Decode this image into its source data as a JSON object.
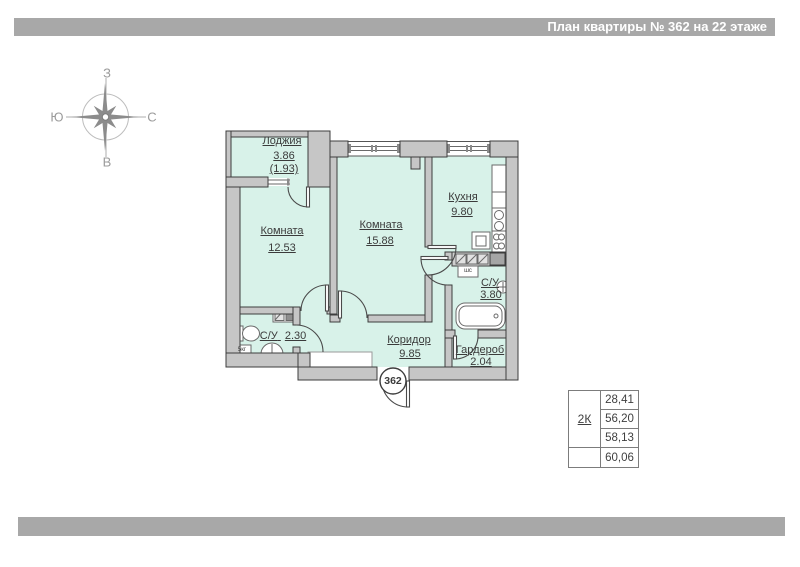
{
  "title_bar": {
    "text": "План квартиры № 362 на 22 этаже"
  },
  "compass": {
    "top": "З",
    "bottom": "В",
    "left": "Ю",
    "right": "С"
  },
  "rooms": {
    "loggia": {
      "name": "Лоджия",
      "area": "3.86",
      "area_reduced": "(1.93)"
    },
    "room1": {
      "name": "Комната",
      "area": "12.53"
    },
    "room2": {
      "name": "Комната",
      "area": "15.88"
    },
    "kitchen": {
      "name": "Кухня",
      "area": "9.80"
    },
    "bathroom": {
      "name": "С/У",
      "area": "3.80"
    },
    "wc": {
      "name": "С/У",
      "area": "2.30"
    },
    "corridor": {
      "name": "Коридор",
      "area": "9.85"
    },
    "wardrobe": {
      "name": "Гардероб",
      "area": "2.04"
    }
  },
  "markers": {
    "apartment_number": "362",
    "washer": "5кг",
    "duct": "шс"
  },
  "summary_table": {
    "apartment_type": "2К",
    "rows": [
      "28,41",
      "56,20",
      "58,13",
      "60,06"
    ]
  },
  "colors": {
    "bar_gray": "#a8a8a8",
    "wall_fill": "#c6c6c6",
    "wall_stroke": "#3d3d3d",
    "floor_mint": "#d8f2e9",
    "label_text": "#3b3b3b",
    "compass_gray": "#9b9b9b"
  }
}
